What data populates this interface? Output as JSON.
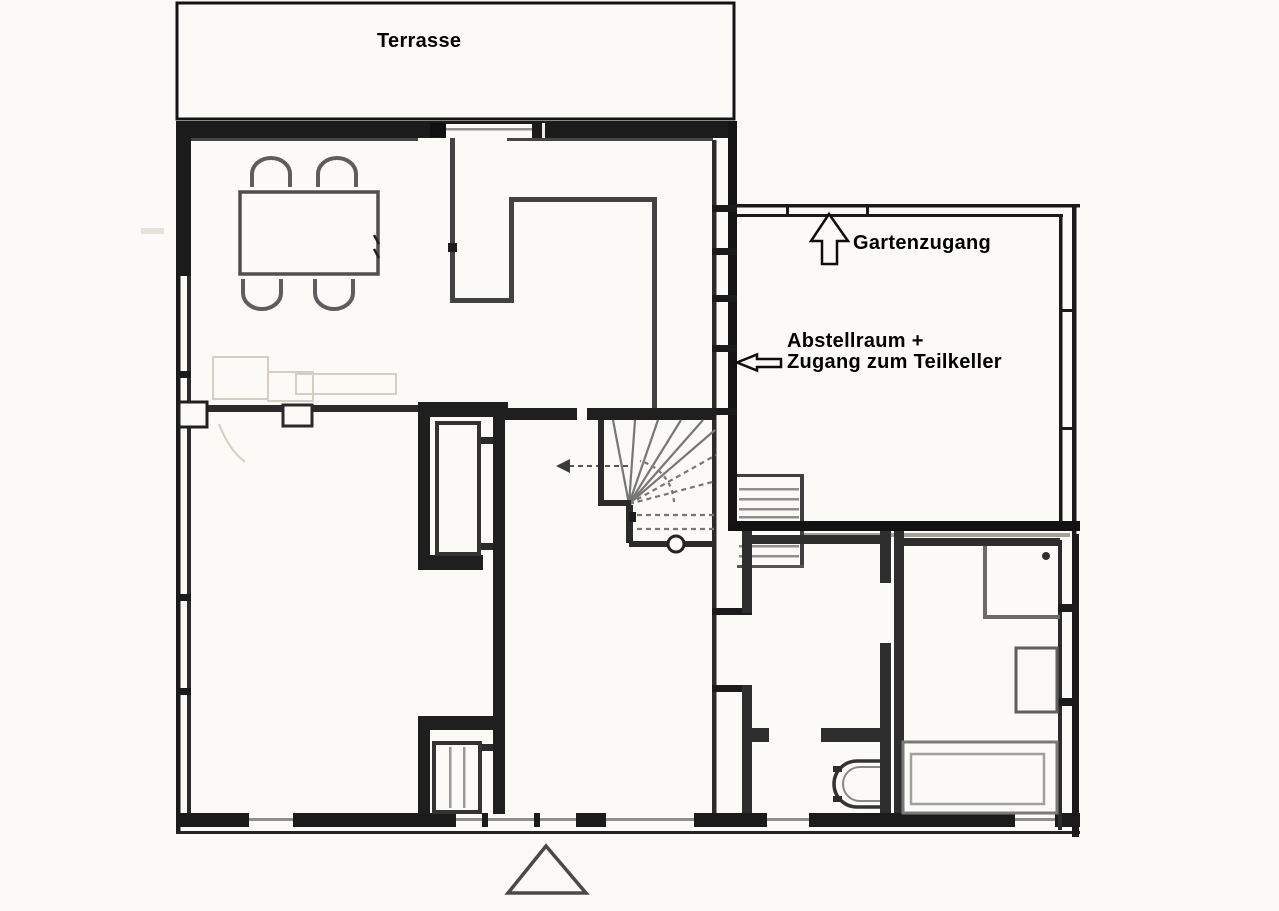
{
  "document": {
    "type": "scanned floor plan (ground floor)",
    "language": "de"
  },
  "labels": {
    "terrace": "Terrasse",
    "garden_access": "Gartenzugang",
    "storage_room_line1": "Abstellraum +",
    "storage_room_line2": "Zugang zum Teilkeller"
  },
  "annotations": [
    {
      "text": "Gartenzugang",
      "arrow": "up-outline-arrow",
      "points_to": "garden door in storage-room top wall"
    },
    {
      "text": "Abstellraum + Zugang zum Teilkeller",
      "arrow": "left-outline-arrow",
      "points_to": "storage room with stairs to partial cellar"
    }
  ],
  "fixtures_visible": [
    "dining-table",
    "chair x4",
    "winder-staircase",
    "stair-newel-post",
    "cellar-stairs",
    "built-in-closet x2",
    "toilet",
    "bathtub",
    "washbasin",
    "shower",
    "north-triangle-marker",
    "terrace-door"
  ],
  "colors": {
    "paper": "#fbfaf6",
    "outer_wall": "#1b1b1b",
    "interior_wall": "#2e2e2e",
    "partition_line": "#424242",
    "fixture_gray": "#5f5f5f",
    "glass_line": "#8f8f8f",
    "pencil_sketch": "#d5cec1",
    "text": "#000000"
  }
}
